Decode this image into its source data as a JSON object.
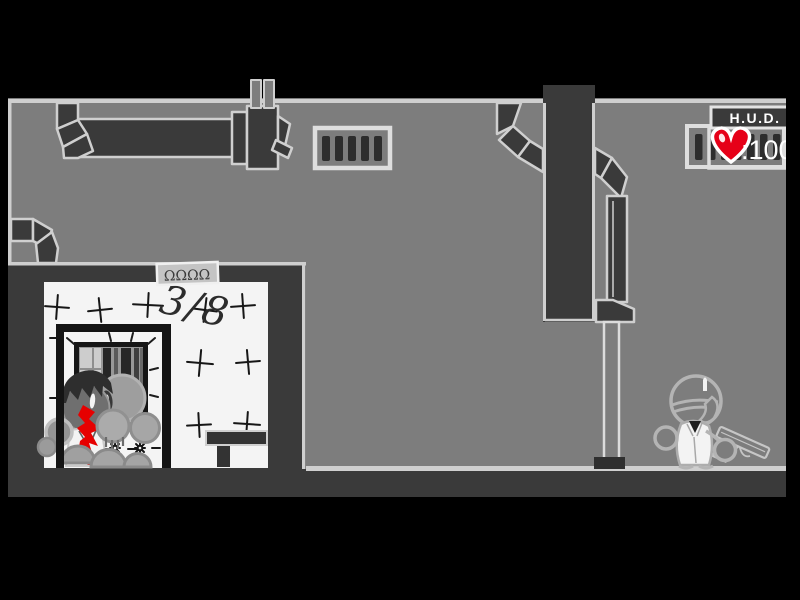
{
  "hud": {
    "title": "H.U.D.",
    "health_value": ":100"
  },
  "room": {
    "tally_text": "3/8",
    "sign_text": "ΩΩΩΩ"
  },
  "colors": {
    "background_gray": "#7d7d7d",
    "structure_dark": "#3a3a3a",
    "outline_light": "#cfcfcf",
    "room_white": "#f4f4f4",
    "blood_red": "#e60000",
    "heart_red": "#e60018"
  }
}
